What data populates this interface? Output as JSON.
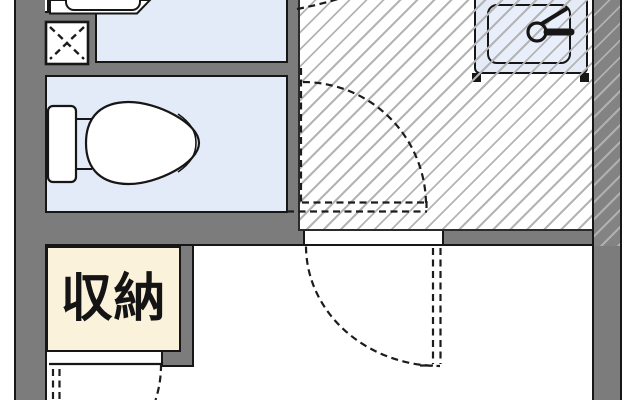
{
  "floorplan": {
    "type": "japanese-apartment-floor-plan",
    "storage_label": "収納",
    "colors": {
      "room_fill": "#e3eaf8",
      "wall_fill": "#7c7c7c",
      "outline": "#161616",
      "hatch_line": "#b4b4b4",
      "storage_fill": "#faf2da",
      "sink_counter_fill": "#e4ebf7",
      "background": "#ffffff"
    },
    "areas": {
      "washroom": {
        "fixture": "bathtub-icon"
      },
      "laundry": {
        "fixture": "washing-machine-pan-icon"
      },
      "toilet_room": {
        "fixture": "toilet-icon"
      },
      "kitchen": {
        "fixture": "kitchen-sink-faucet-icon",
        "floor": "diagonal-hatch"
      },
      "main_room": {},
      "storage": {
        "label": "収納"
      }
    },
    "doors": [
      {
        "name": "kitchen-door-swing"
      },
      {
        "name": "main-room-door-swing"
      },
      {
        "name": "storage-door-swing"
      },
      {
        "name": "bath-door-swing-partial"
      }
    ]
  }
}
